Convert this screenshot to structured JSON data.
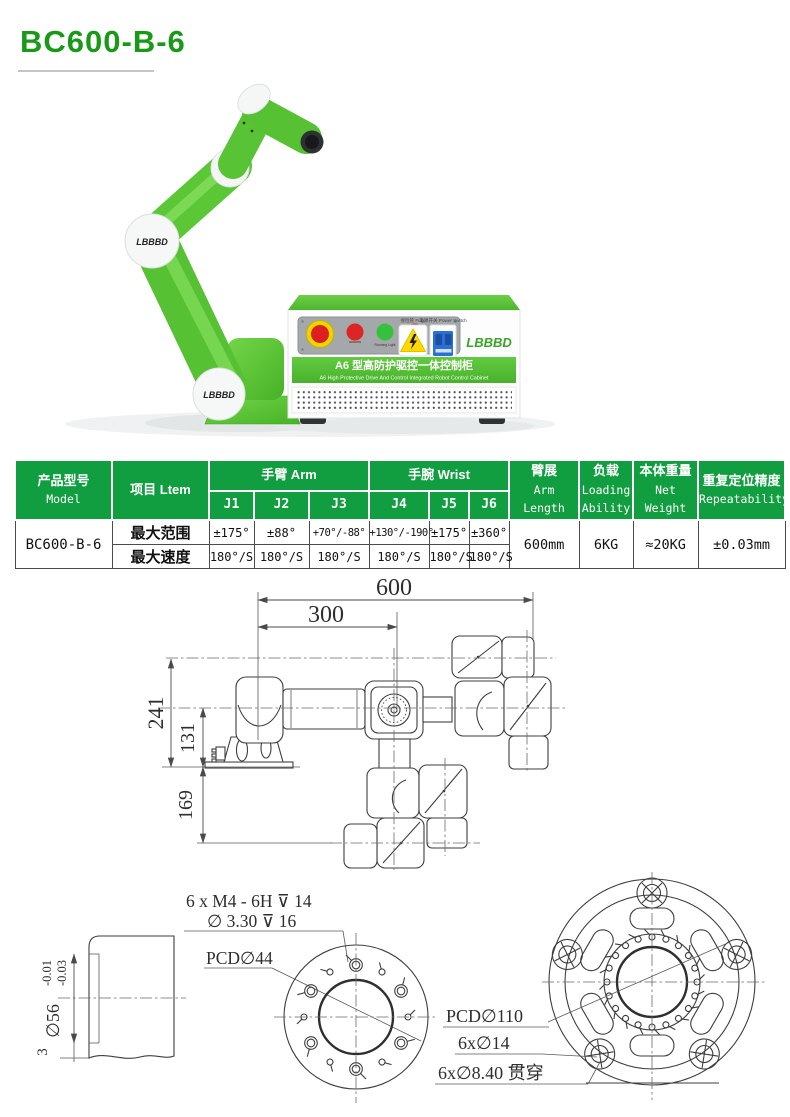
{
  "page": {
    "title": "BC600-B-6"
  },
  "brand": "LBBBD",
  "hero": {
    "cabinet": {
      "title_zh": "A6 型高防护驱控一体控制柜",
      "title_en": "A6 High Protective Drive And Control Integrated Robot Control Cabinet",
      "fuse_label": "保险管 Fuse",
      "power_switch_label": "电源开关 Power Switch",
      "running_light_label": "Running Light",
      "alarm_light_label": "Alarm Light"
    }
  },
  "table": {
    "col_model_zh": "产品型号",
    "col_model_en": "Model",
    "col_item": "项目 Ltem",
    "group_arm": "手臂 Arm",
    "group_wrist": "手腕 Wrist",
    "joints": [
      "J1",
      "J2",
      "J3",
      "J4",
      "J5",
      "J6"
    ],
    "col_arm_length_zh": "臂展",
    "col_arm_length_en": "Arm Length",
    "col_loading_zh": "负载",
    "col_loading_en": "Loading Ability",
    "col_weight_zh": "本体重量",
    "col_weight_en": "Net Weight",
    "col_repeat_zh": "重复定位精度",
    "col_repeat_en": "Repeatability",
    "model_value": "BC600-B-6",
    "row_range_label": "最大范围",
    "row_speed_label": "最大速度",
    "range_values": [
      "±175°",
      "±88°",
      "+70°/-88°",
      "+130°/-190°",
      "±175°",
      "±360°"
    ],
    "speed_values": [
      "180°/S",
      "180°/S",
      "180°/S",
      "180°/S",
      "180°/S",
      "180°/S"
    ],
    "arm_length": "600mm",
    "loading": "6KG",
    "net_weight": "≈20KG",
    "repeatability": "±0.03mm",
    "header_bg": "#119e40"
  },
  "drawing": {
    "dims": {
      "d600": "600",
      "d300": "300",
      "d241": "241",
      "d131": "131",
      "d169": "169"
    },
    "tool_flange": {
      "thread_note": "6 x  M4 - 6H ⊽ 14",
      "hole_note": "∅ 3.30 ⊽ 16",
      "pcd_note": "PCD∅44",
      "dia": "∅56",
      "tol_upper": "-0.01",
      "tol_lower": "-0.03",
      "step": "3"
    },
    "base_flange": {
      "pcd_note": "PCD∅110",
      "bolt_note": "6x∅14",
      "through_note": "6x∅8.40 贯穿"
    }
  }
}
